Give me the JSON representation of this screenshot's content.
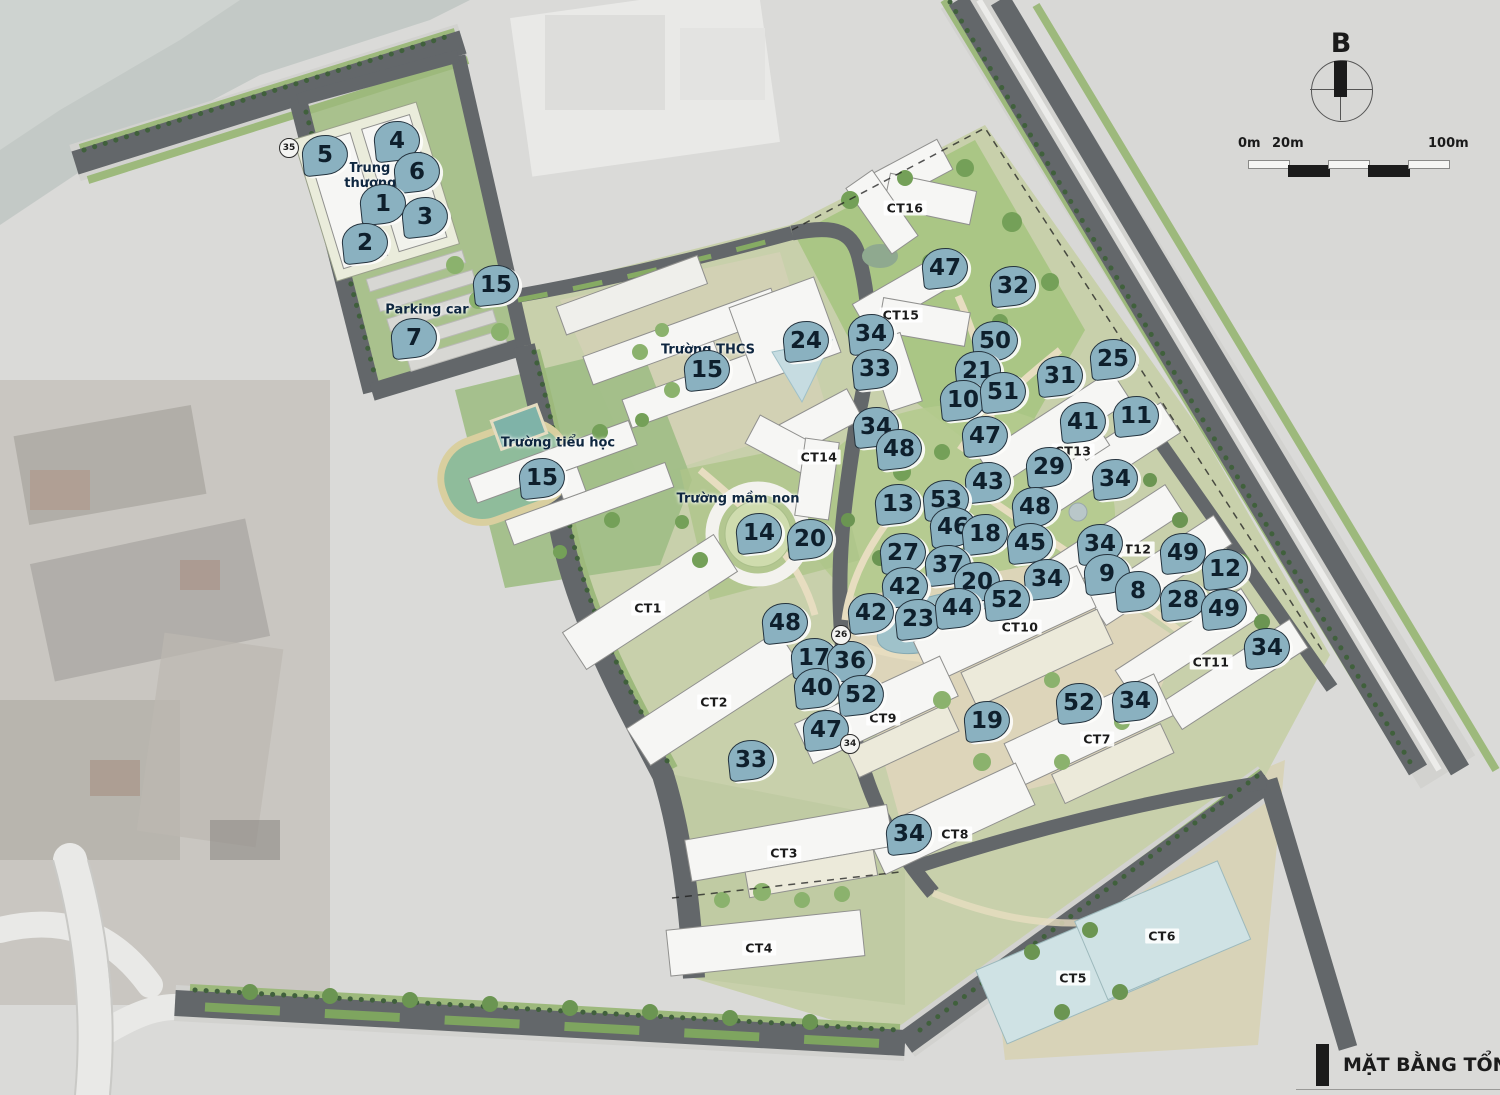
{
  "title_block": {
    "title": "MẶT BẰNG TỔNG THỂ"
  },
  "compass": {
    "label": "B"
  },
  "scale_bar": {
    "labels": [
      "0m",
      "20m",
      "100m"
    ]
  },
  "colors": {
    "marker_fill": "#8ab1c0",
    "marker_border": "#24333e",
    "marker_text": "#0e1f2c",
    "road": "#63676a",
    "park_green": "#a9c583",
    "water": "#9fc2ca"
  },
  "places": [
    {
      "label": "Trung tâm\nthương mại",
      "x": 386,
      "y": 176
    },
    {
      "label": "Parking car",
      "x": 427,
      "y": 310
    },
    {
      "label": "Trường THCS",
      "x": 708,
      "y": 350
    },
    {
      "label": "Trường tiểu học",
      "x": 558,
      "y": 443
    },
    {
      "label": "Trường mầm non",
      "x": 738,
      "y": 499
    }
  ],
  "buildings": [
    {
      "label": "CT1",
      "x": 648,
      "y": 608
    },
    {
      "label": "CT2",
      "x": 714,
      "y": 702
    },
    {
      "label": "CT3",
      "x": 784,
      "y": 853
    },
    {
      "label": "CT4",
      "x": 759,
      "y": 948
    },
    {
      "label": "CT5",
      "x": 1073,
      "y": 978
    },
    {
      "label": "CT6",
      "x": 1162,
      "y": 936
    },
    {
      "label": "CT7",
      "x": 1097,
      "y": 739
    },
    {
      "label": "CT8",
      "x": 955,
      "y": 834
    },
    {
      "label": "CT9",
      "x": 883,
      "y": 718
    },
    {
      "label": "CT10",
      "x": 1020,
      "y": 627
    },
    {
      "label": "CT11",
      "x": 1211,
      "y": 662
    },
    {
      "label": "CT12",
      "x": 1133,
      "y": 549
    },
    {
      "label": "CT13",
      "x": 1073,
      "y": 451
    },
    {
      "label": "CT14",
      "x": 819,
      "y": 457
    },
    {
      "label": "CT15",
      "x": 901,
      "y": 315
    },
    {
      "label": "CT16",
      "x": 905,
      "y": 208
    }
  ],
  "markers": [
    {
      "n": "5",
      "x": 325,
      "y": 155
    },
    {
      "n": "4",
      "x": 397,
      "y": 141
    },
    {
      "n": "6",
      "x": 417,
      "y": 172
    },
    {
      "n": "1",
      "x": 383,
      "y": 204
    },
    {
      "n": "3",
      "x": 425,
      "y": 217
    },
    {
      "n": "2",
      "x": 365,
      "y": 243
    },
    {
      "n": "15",
      "x": 496,
      "y": 285
    },
    {
      "n": "7",
      "x": 414,
      "y": 338
    },
    {
      "n": "47",
      "x": 945,
      "y": 268
    },
    {
      "n": "32",
      "x": 1013,
      "y": 286
    },
    {
      "n": "24",
      "x": 806,
      "y": 341
    },
    {
      "n": "34",
      "x": 871,
      "y": 334
    },
    {
      "n": "33",
      "x": 875,
      "y": 369
    },
    {
      "n": "50",
      "x": 995,
      "y": 341
    },
    {
      "n": "21",
      "x": 978,
      "y": 371
    },
    {
      "n": "25",
      "x": 1113,
      "y": 359
    },
    {
      "n": "31",
      "x": 1060,
      "y": 376
    },
    {
      "n": "10",
      "x": 963,
      "y": 400
    },
    {
      "n": "51",
      "x": 1003,
      "y": 392
    },
    {
      "n": "11",
      "x": 1136,
      "y": 416
    },
    {
      "n": "41",
      "x": 1083,
      "y": 422
    },
    {
      "n": "15",
      "x": 707,
      "y": 370
    },
    {
      "n": "34",
      "x": 876,
      "y": 427
    },
    {
      "n": "48",
      "x": 899,
      "y": 449
    },
    {
      "n": "47",
      "x": 985,
      "y": 436
    },
    {
      "n": "29",
      "x": 1049,
      "y": 467
    },
    {
      "n": "34",
      "x": 1115,
      "y": 479
    },
    {
      "n": "43",
      "x": 988,
      "y": 482
    },
    {
      "n": "13",
      "x": 898,
      "y": 504
    },
    {
      "n": "53",
      "x": 946,
      "y": 500
    },
    {
      "n": "48",
      "x": 1035,
      "y": 507
    },
    {
      "n": "15",
      "x": 542,
      "y": 478
    },
    {
      "n": "46",
      "x": 953,
      "y": 527
    },
    {
      "n": "18",
      "x": 985,
      "y": 534
    },
    {
      "n": "45",
      "x": 1030,
      "y": 543
    },
    {
      "n": "14",
      "x": 759,
      "y": 533
    },
    {
      "n": "20",
      "x": 810,
      "y": 539
    },
    {
      "n": "27",
      "x": 903,
      "y": 553
    },
    {
      "n": "34",
      "x": 1100,
      "y": 544
    },
    {
      "n": "49",
      "x": 1183,
      "y": 553
    },
    {
      "n": "37",
      "x": 948,
      "y": 565
    },
    {
      "n": "12",
      "x": 1225,
      "y": 569
    },
    {
      "n": "42",
      "x": 905,
      "y": 587
    },
    {
      "n": "20",
      "x": 977,
      "y": 582
    },
    {
      "n": "34",
      "x": 1047,
      "y": 579
    },
    {
      "n": "9",
      "x": 1107,
      "y": 574
    },
    {
      "n": "8",
      "x": 1138,
      "y": 591
    },
    {
      "n": "52",
      "x": 1007,
      "y": 600
    },
    {
      "n": "28",
      "x": 1183,
      "y": 600
    },
    {
      "n": "49",
      "x": 1224,
      "y": 609
    },
    {
      "n": "42",
      "x": 871,
      "y": 613
    },
    {
      "n": "23",
      "x": 918,
      "y": 619
    },
    {
      "n": "44",
      "x": 958,
      "y": 608
    },
    {
      "n": "48",
      "x": 785,
      "y": 623
    },
    {
      "n": "34",
      "x": 1267,
      "y": 648
    },
    {
      "n": "17",
      "x": 814,
      "y": 658
    },
    {
      "n": "36",
      "x": 850,
      "y": 661
    },
    {
      "n": "40",
      "x": 817,
      "y": 688
    },
    {
      "n": "52",
      "x": 861,
      "y": 695
    },
    {
      "n": "19",
      "x": 987,
      "y": 721
    },
    {
      "n": "52",
      "x": 1079,
      "y": 703
    },
    {
      "n": "34",
      "x": 1135,
      "y": 701
    },
    {
      "n": "47",
      "x": 826,
      "y": 730
    },
    {
      "n": "33",
      "x": 751,
      "y": 760
    },
    {
      "n": "34",
      "x": 909,
      "y": 834
    }
  ],
  "circle_markers": [
    {
      "n": "35",
      "x": 289,
      "y": 148
    },
    {
      "n": "26",
      "x": 841,
      "y": 635
    },
    {
      "n": "34",
      "x": 850,
      "y": 744
    }
  ]
}
